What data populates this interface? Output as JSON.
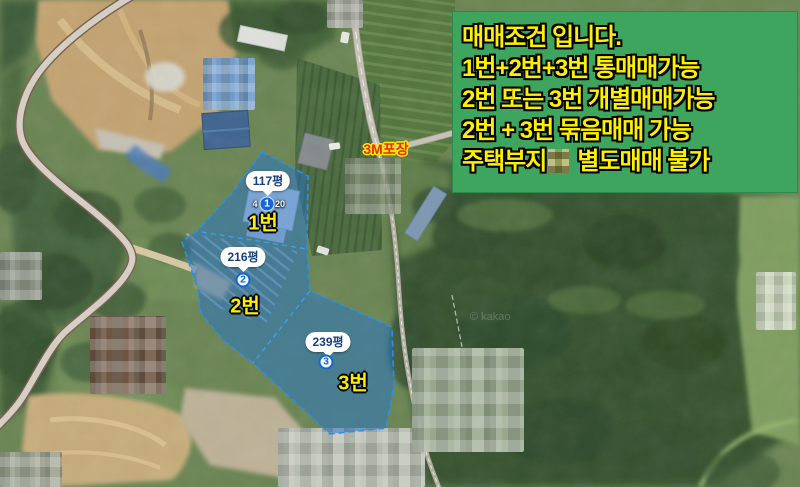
{
  "notice_box": {
    "lines": [
      "매매조건 입니다.",
      "1번+2번+3번 통매매가능",
      "2번 또는 3번 개별매매가능",
      "2번 + 3번 묶음매매 가능"
    ],
    "redacted_line": {
      "prefix": "주택부지",
      "suffix": "별도매매 불가"
    },
    "bg_color": "#3ea55f",
    "text_color": "#ffef00"
  },
  "map_annotations": {
    "road_surface_label": "3M포장",
    "highlight_color": "#2f8fe6",
    "parcel_label_color": "#ffef00",
    "parcels": [
      {
        "area": "117평",
        "marker_number": "1",
        "label": "1번",
        "address_fragment_left": "4",
        "address_fragment_right": "20"
      },
      {
        "area": "216평",
        "marker_number": "2",
        "label": "2번"
      },
      {
        "area": "239평",
        "marker_number": "3",
        "label": "3번"
      }
    ]
  },
  "watermark": "© kakao"
}
